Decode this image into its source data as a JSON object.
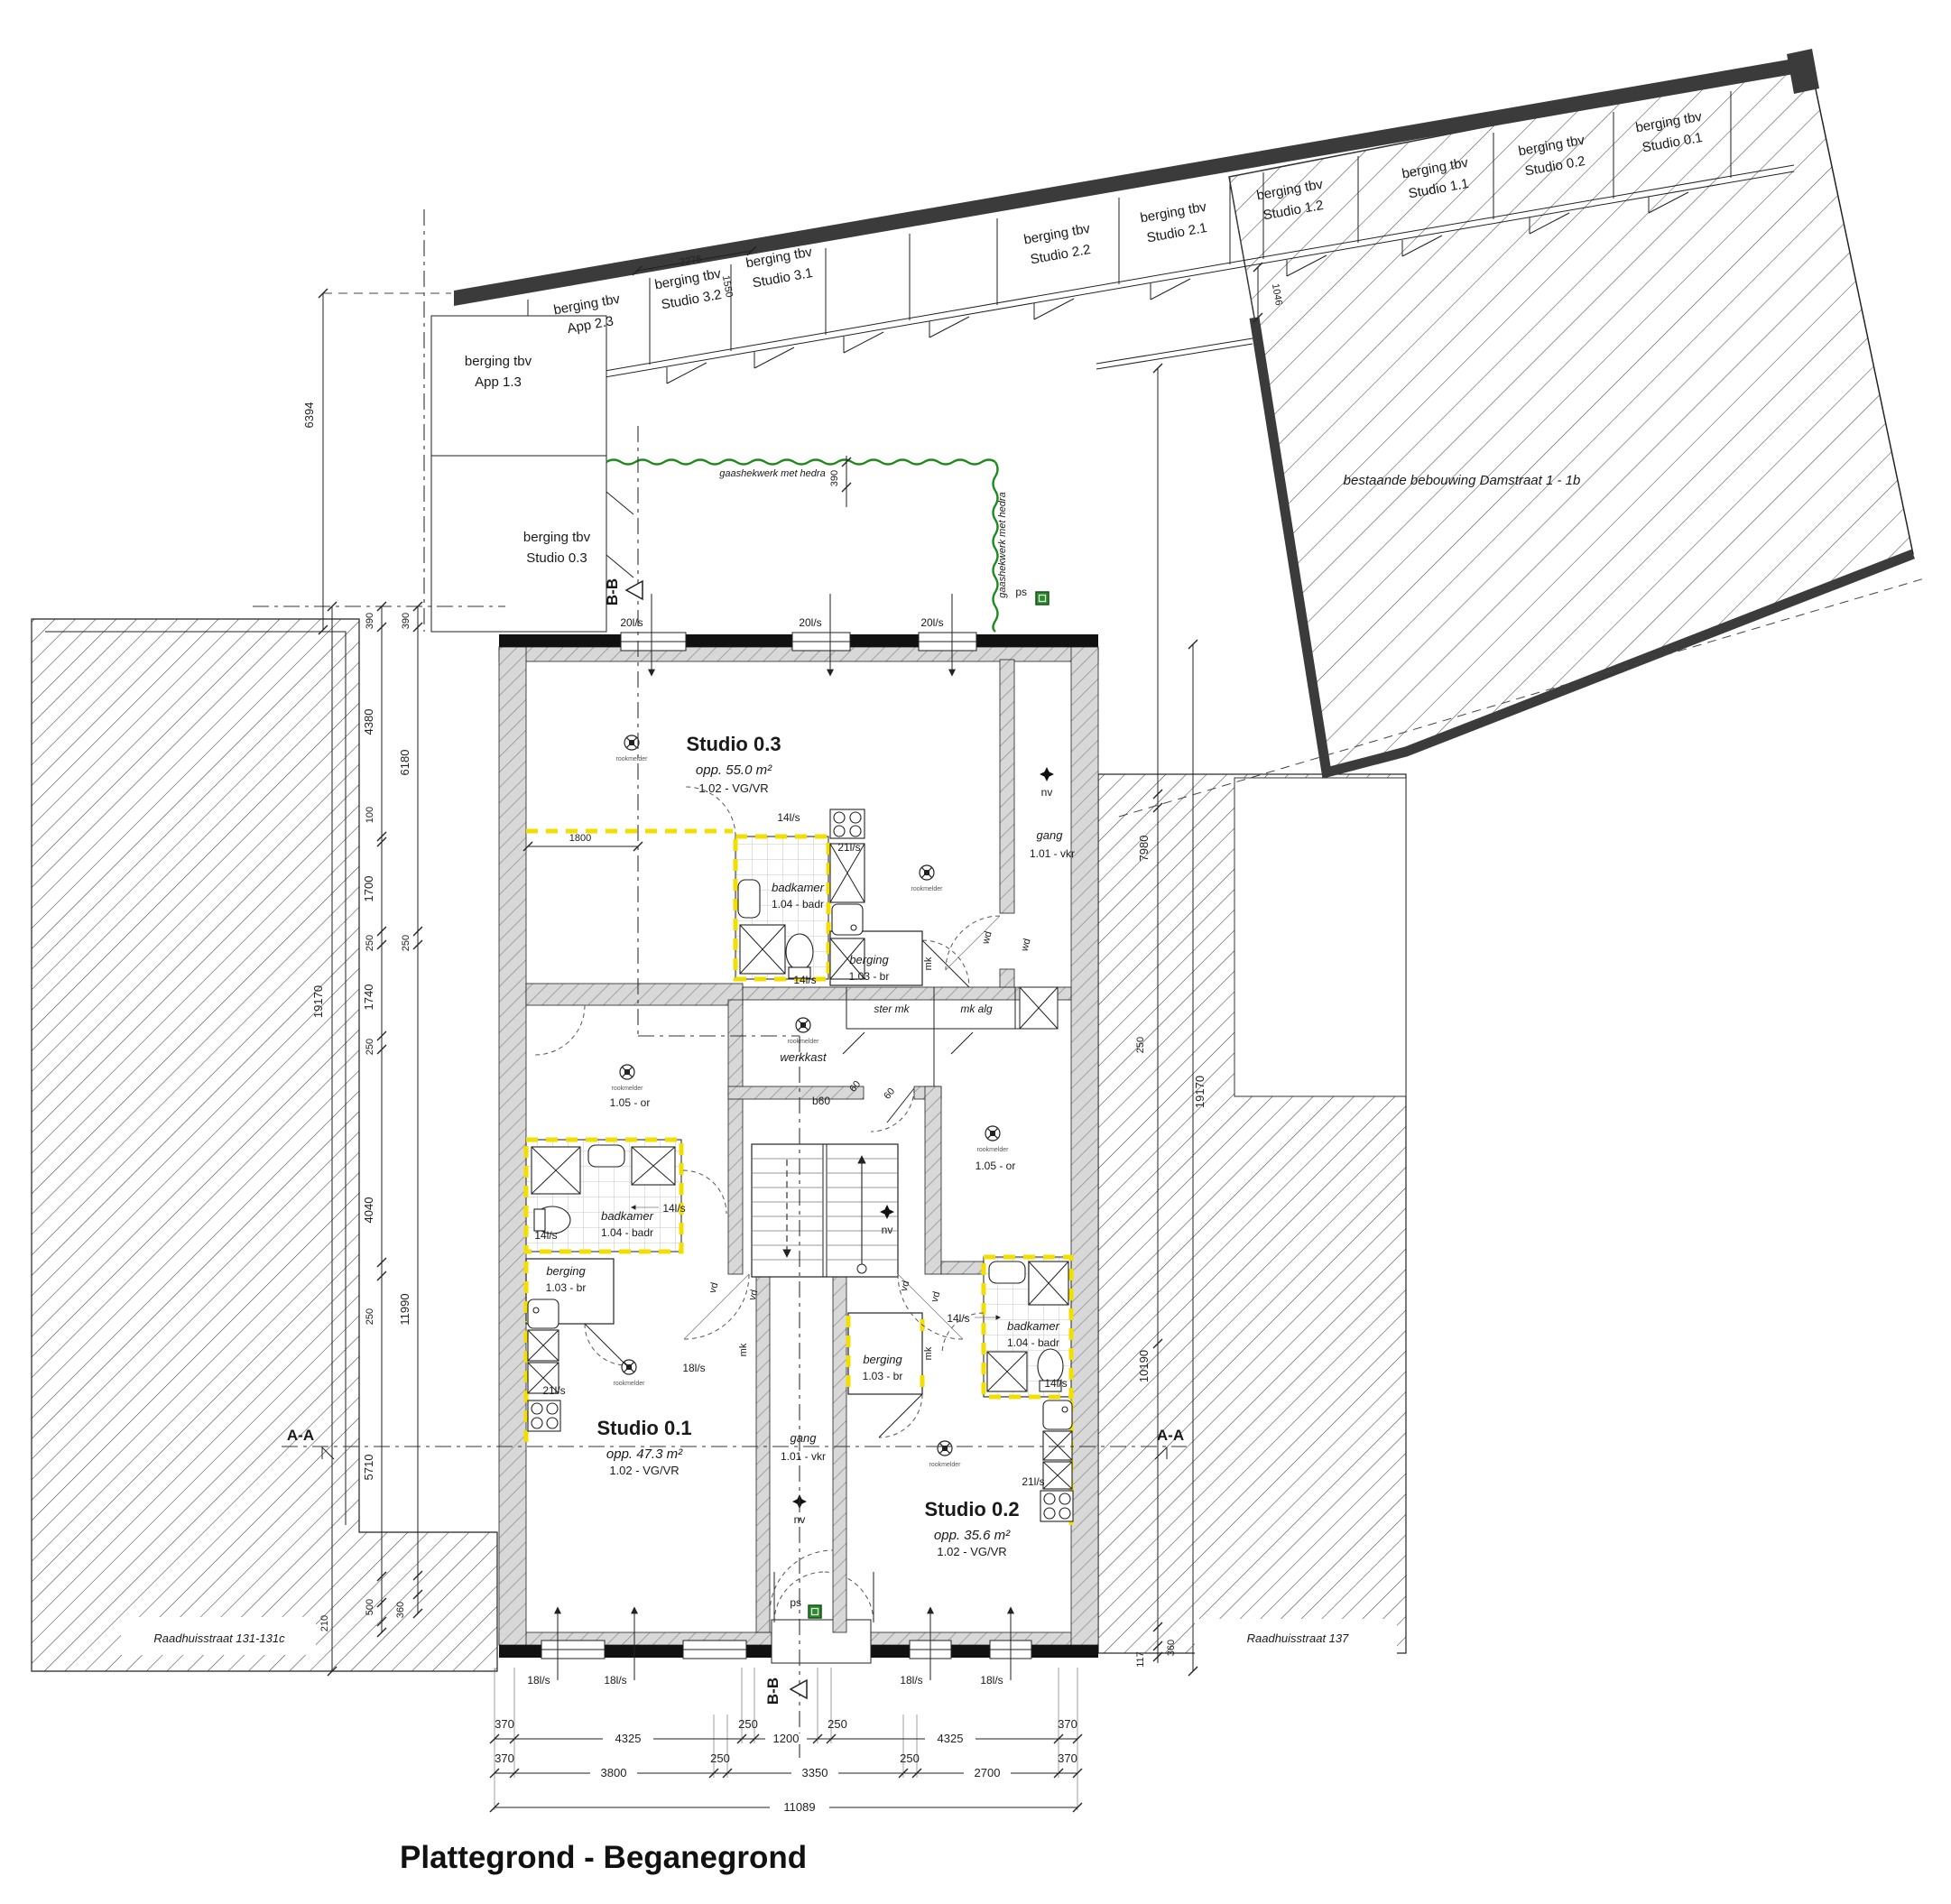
{
  "title": "Plattegrond - Beganegrond",
  "streets": {
    "left": "Raadhuisstraat 131-131c",
    "right": "Raadhuisstraat 137"
  },
  "annotations": {
    "existing_building": "bestaande bebouwing Damstraat 1 - 1b",
    "fence": "gaashekwerk met hedra"
  },
  "storage_units": [
    {
      "l1": "berging tbv",
      "l2": "App 1.3"
    },
    {
      "l1": "berging tbv",
      "l2": "App 2.3"
    },
    {
      "l1": "berging tbv",
      "l2": "Studio 3.2"
    },
    {
      "l1": "berging tbv",
      "l2": "Studio 3.1"
    },
    {
      "l1": "berging tbv",
      "l2": "Studio 2.2"
    },
    {
      "l1": "berging tbv",
      "l2": "Studio 2.1"
    },
    {
      "l1": "berging tbv",
      "l2": "Studio 1.2"
    },
    {
      "l1": "berging tbv",
      "l2": "Studio 1.1"
    },
    {
      "l1": "berging tbv",
      "l2": "Studio 0.2"
    },
    {
      "l1": "berging tbv",
      "l2": "Studio 0.1"
    },
    {
      "l1": "berging tbv",
      "l2": "Studio 0.3"
    }
  ],
  "rooms": {
    "studio03": {
      "name": "Studio 0.3",
      "area": "opp. 55.0 m²",
      "code": "1.02 - VG/VR"
    },
    "studio01": {
      "name": "Studio 0.1",
      "area": "opp. 47.3 m²",
      "code": "1.02 - VG/VR"
    },
    "studio02": {
      "name": "Studio 0.2",
      "area": "opp. 35.6 m²",
      "code": "1.02 - VG/VR"
    },
    "gang": {
      "name": "gang",
      "code": "1.01 - vkr"
    },
    "badkamer": {
      "name": "badkamer",
      "code": "1.04 - badr"
    },
    "berging": {
      "name": "berging",
      "code": "1.03 - br"
    },
    "werkkast": "werkkast",
    "or_room": "1.05 - or",
    "ster_mk": "ster mk",
    "mk_alg": "mk alg"
  },
  "vent": {
    "v20": "20l/s",
    "v18": "18l/s",
    "v14": "14l/s",
    "v21": "21l/s",
    "b60": "b60",
    "v60": "60"
  },
  "tags": {
    "nv": "nv",
    "ps": "ps",
    "mk": "mk",
    "wd": "wd",
    "vd": "vd",
    "rookmelder": "rookmelder"
  },
  "sections": {
    "aa": "A-A",
    "bb": "B-B"
  },
  "dims": {
    "bottom1": [
      "370",
      "4325",
      "250",
      "1200",
      "250",
      "4325",
      "370"
    ],
    "bottom2": [
      "370",
      "3800",
      "250",
      "3350",
      "250",
      "2700",
      "370"
    ],
    "total": "11089",
    "left": [
      "6394",
      "390",
      "390",
      "4380",
      "6180",
      "100",
      "1700",
      "250",
      "250",
      "1740",
      "250",
      "19170",
      "4040",
      "250",
      "11990",
      "5710",
      "500",
      "360",
      "210"
    ],
    "right": [
      "390",
      "7980",
      "250",
      "19170",
      "10190",
      "360",
      "117"
    ],
    "top": [
      "2276",
      "1550",
      "1046"
    ],
    "inner": "1800"
  }
}
